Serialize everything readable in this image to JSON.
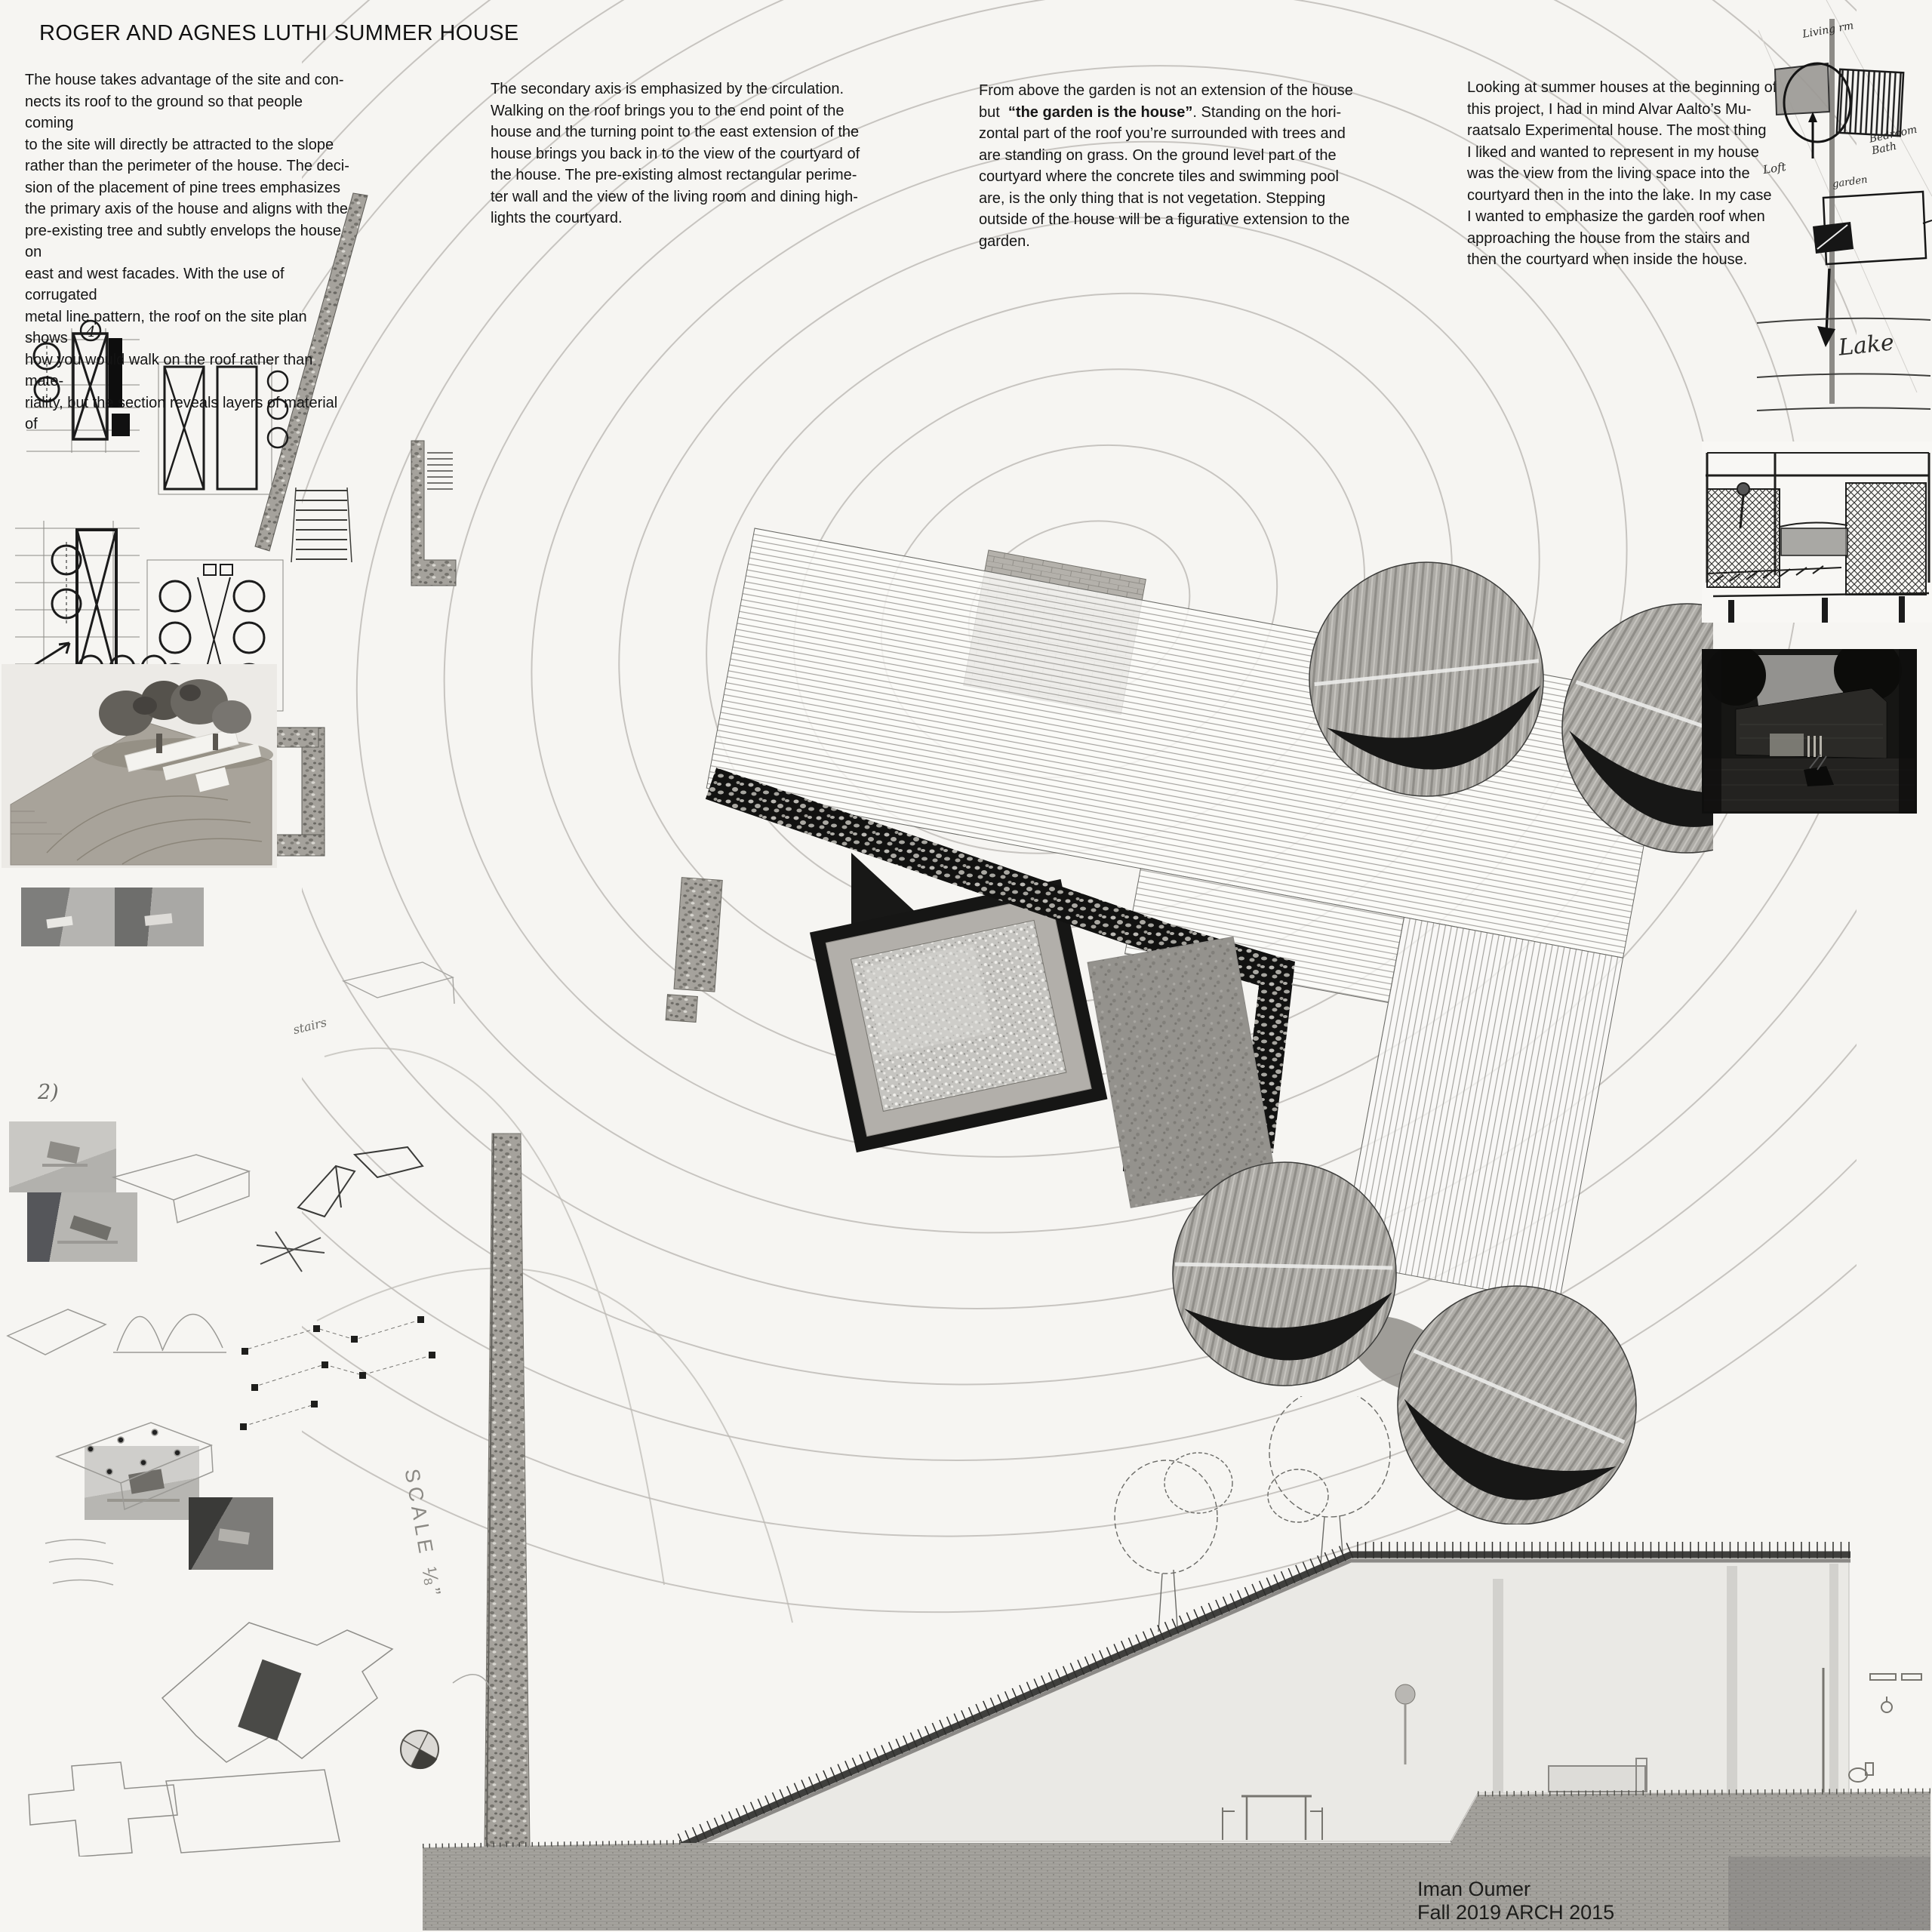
{
  "board": {
    "title": "ROGER AND AGNES LUTHI SUMMER HOUSE",
    "credit_lines": [
      "Iman Oumer",
      "Fall 2019 ARCH 2015"
    ]
  },
  "columns": {
    "col1_lines": [
      "The house takes advantage of the site and con-",
      "nects its roof to the ground so that people coming",
      "to the site will directly be attracted to the slope",
      "rather than the perimeter of the house. The deci-",
      "sion of the placement of pine trees emphasizes",
      "the primary axis of the house and aligns with the",
      "pre-existing tree and subtly envelops the house on",
      "east and west facades. With the use of corrugated",
      "metal line pattern, the roof on the site plan shows",
      "how you would walk on the roof rather than mate-",
      "riality, but the section reveals layers of material of"
    ],
    "col2_lines": [
      "The secondary axis is emphasized by the circulation.",
      "Walking on the roof brings you to the end point of the",
      "house and the turning point to the east extension of the",
      "house brings you back in to the view of the courtyard of",
      "the house. The pre-existing almost rectangular perime-",
      "ter wall and the view of the living room and dining high-",
      "lights the courtyard."
    ],
    "col3": {
      "line1": "From above the garden is not an extension of the house",
      "line2_pre": "but  ",
      "line2_bold": "“the garden is the house”",
      "line2_post": ". Standing on the hori-",
      "rest_lines": [
        "zontal part of the roof you’re surrounded with trees and",
        "are standing on grass. On the ground level part of the",
        "courtyard where the concrete tiles and swimming pool",
        "are, is the only thing that is not vegetation. Stepping",
        "outside of the house will be a figurative extension to the",
        "garden."
      ]
    },
    "col4_lines": [
      "Looking at summer houses at the beginning of",
      "this project,  I had in mind Alvar Aalto’s Mu-",
      "raatsalo Experimental house. The most thing",
      "I liked and wanted to represent in my house",
      "was the view from the living space into the",
      "courtyard then in the into the lake. In my case",
      "I wanted to emphasize the garden roof when",
      "approaching the house from the stairs and",
      "then the courtyard when inside the house."
    ]
  },
  "annotations": {
    "scale_label": "SCALE ⅛”",
    "note_2": "2)",
    "note_stairs": "stairs",
    "sketch_numeral": "4",
    "concept_sketch": {
      "living_room": "Living rm",
      "bedroom_bath": "Bedroom\nBath",
      "loft": "Loft",
      "garden": "garden",
      "lake": "Lake"
    }
  },
  "colors": {
    "paper": "#f6f5f2",
    "ink": "#161616",
    "contour_line": "#bcb9b4",
    "earth": "#a5a39e",
    "stone_dark": "#121211"
  }
}
